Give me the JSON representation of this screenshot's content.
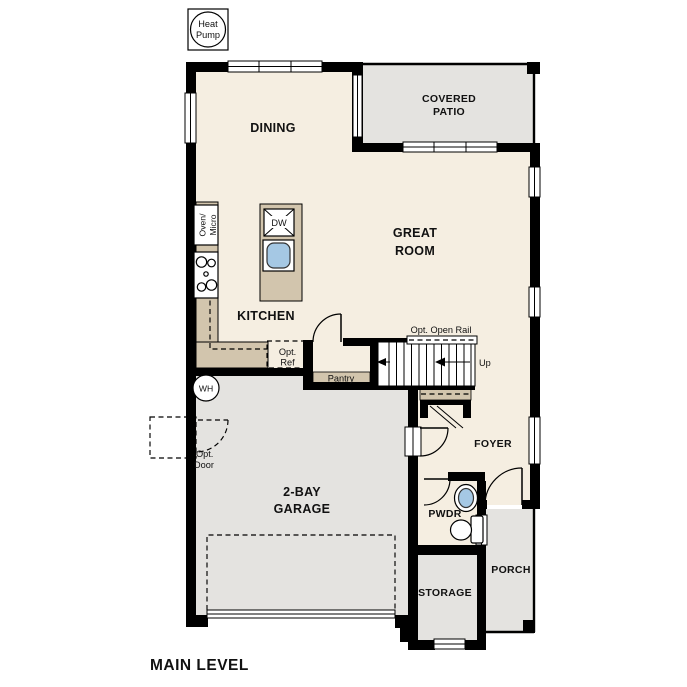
{
  "page": {
    "title": "MAIN LEVEL"
  },
  "colors": {
    "floor_interior": "#f5eee1",
    "floor_outdoor": "#e4e3e0",
    "counter": "#d2c5ad",
    "wall": "#000000",
    "sink_blue": "#a5c8e4"
  },
  "rooms": {
    "dining": "DINING",
    "covered_patio": [
      "COVERED",
      "PATIO"
    ],
    "great_room": [
      "GREAT",
      "ROOM"
    ],
    "kitchen": "KITCHEN",
    "pantry": "Pantry",
    "foyer": "FOYER",
    "powder": "PWDR",
    "garage": [
      "2-BAY",
      "GARAGE"
    ],
    "porch": "PORCH",
    "storage": "STORAGE"
  },
  "equipment": {
    "heat_pump": [
      "Heat",
      "Pump"
    ],
    "water_heater": "WH",
    "oven_micro": [
      "Oven/",
      "Micro"
    ],
    "dishwasher": "DW"
  },
  "annotations": {
    "opt_open_rail": "Opt. Open Rail",
    "up": "Up",
    "opt_ref": [
      "Opt.",
      "Ref"
    ],
    "opt_door": [
      "Opt.",
      "Door"
    ]
  }
}
